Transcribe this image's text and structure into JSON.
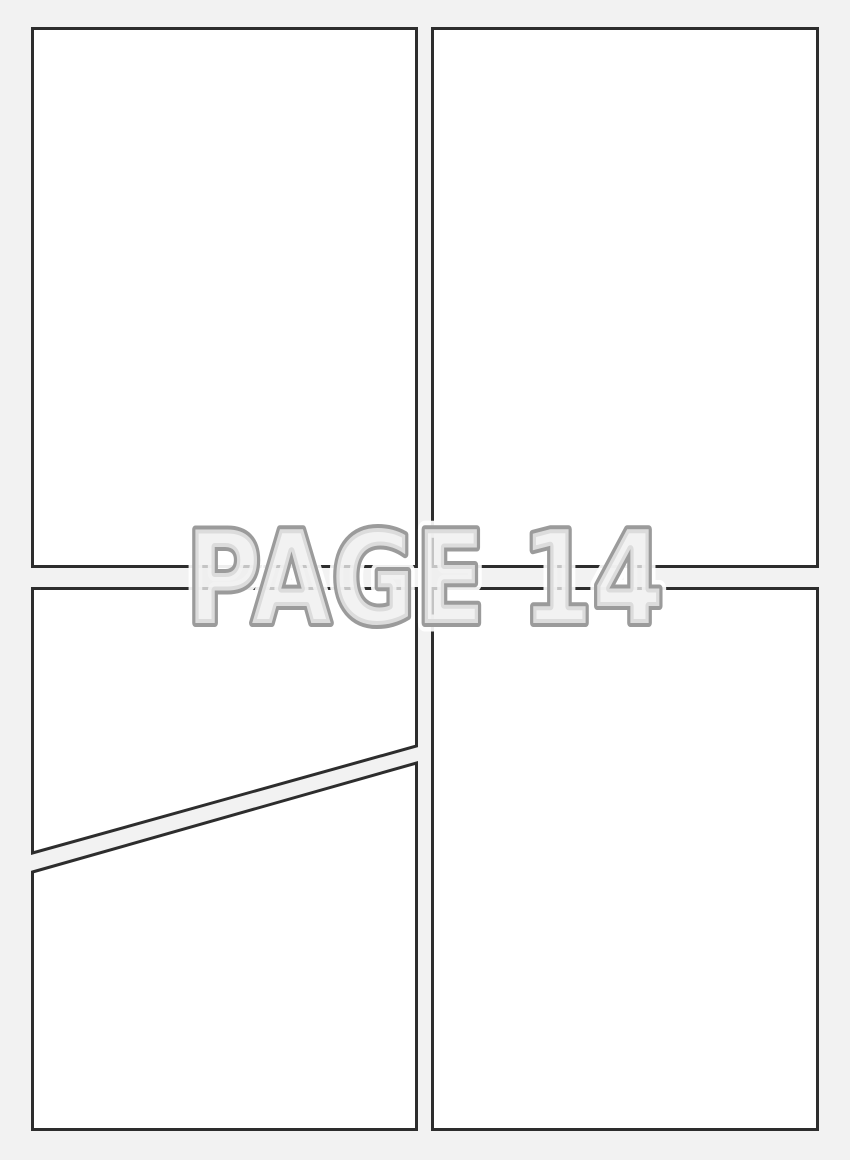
{
  "page": {
    "label": "PAGE 14",
    "colors": {
      "background": "#f2f2f2",
      "panel_fill": "#ffffff",
      "panel_border": "#2d2d2d",
      "label_fill": "#eeeeee",
      "label_outline": "#9b9b9b",
      "label_halo": "#ffffff"
    },
    "panels": [
      {
        "id": "top-left"
      },
      {
        "id": "top-right"
      },
      {
        "id": "middle-left"
      },
      {
        "id": "bottom-left"
      },
      {
        "id": "bottom-right"
      }
    ]
  }
}
